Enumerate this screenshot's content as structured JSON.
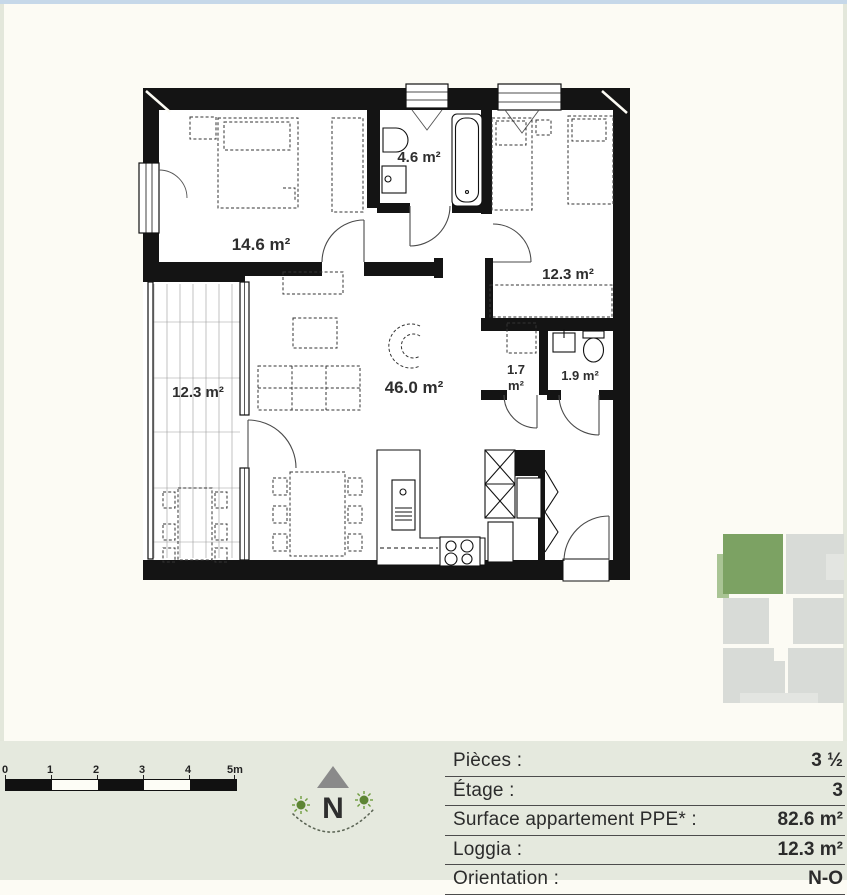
{
  "page": {
    "background": "#fcfbf4",
    "band_color": "#e5e9de",
    "top_strip_color": "#c6d8e9",
    "wall_color": "#141414",
    "accent_green": "#7ca263"
  },
  "plan": {
    "rooms": [
      {
        "id": "bedroom-1",
        "area": "14.6 m²"
      },
      {
        "id": "bathroom",
        "area": "4.6 m²"
      },
      {
        "id": "bedroom-2",
        "area": "12.3 m²"
      },
      {
        "id": "living",
        "area": "46.0 m²"
      },
      {
        "id": "reduit",
        "area_line1": "1.7",
        "area_line2": "m²"
      },
      {
        "id": "wc",
        "area": "1.9 m²"
      },
      {
        "id": "loggia",
        "area": "12.3 m²"
      }
    ]
  },
  "scale_bar": {
    "labels": [
      "0",
      "1",
      "2",
      "3",
      "4",
      "5m"
    ]
  },
  "compass": {
    "north_label": "N"
  },
  "info": {
    "rows": [
      {
        "label": "Pièces :",
        "value": "3 ½"
      },
      {
        "label": "Étage :",
        "value": "3"
      },
      {
        "label": "Surface appartement PPE* :",
        "value": "82.6 m²"
      },
      {
        "label": "Loggia :",
        "value": "12.3 m²"
      },
      {
        "label": "Orientation :",
        "value": "N-O"
      }
    ]
  },
  "minimap": {
    "highlight_color": "#7ca263",
    "highlight_light": "#a9c494",
    "block_color": "#d8dbd7",
    "block_light": "#e3e5e1"
  }
}
